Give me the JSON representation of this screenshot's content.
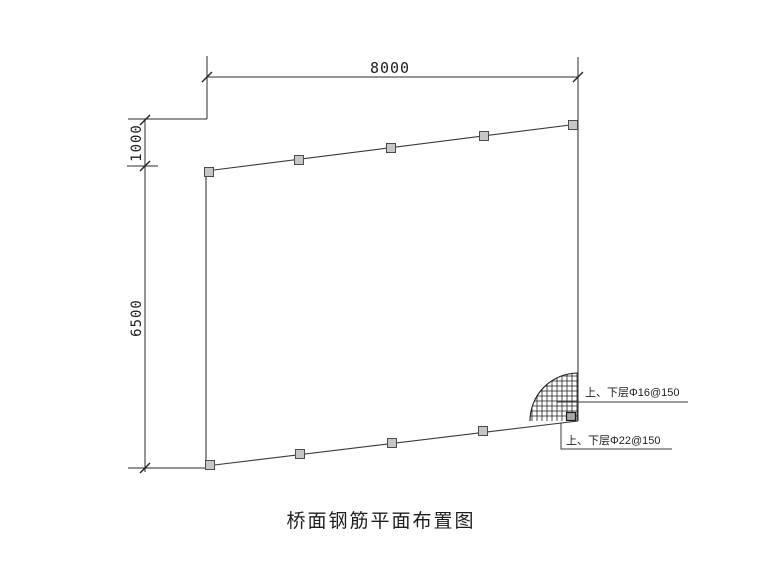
{
  "drawing": {
    "title": "桥面钢筋平面布置图",
    "dimensions": {
      "top_width": "8000",
      "left_upper": "1000",
      "left_lower": "6500"
    },
    "annotations": {
      "rebar_upper_lower_16": "上、下层Φ16@150",
      "rebar_upper_lower_22": "上、下层Φ22@150"
    },
    "colors": {
      "background": "#ffffff",
      "line": "#3a3a3a",
      "dimension_line": "#2b2b2b",
      "text": "#1e1e1e",
      "marker_square_fill": "#c6c6c6",
      "marker_square_border": "#4b4b4b",
      "corner_square_fill": "#a8a8a8",
      "hatch_line": "#1f1f1f"
    }
  }
}
